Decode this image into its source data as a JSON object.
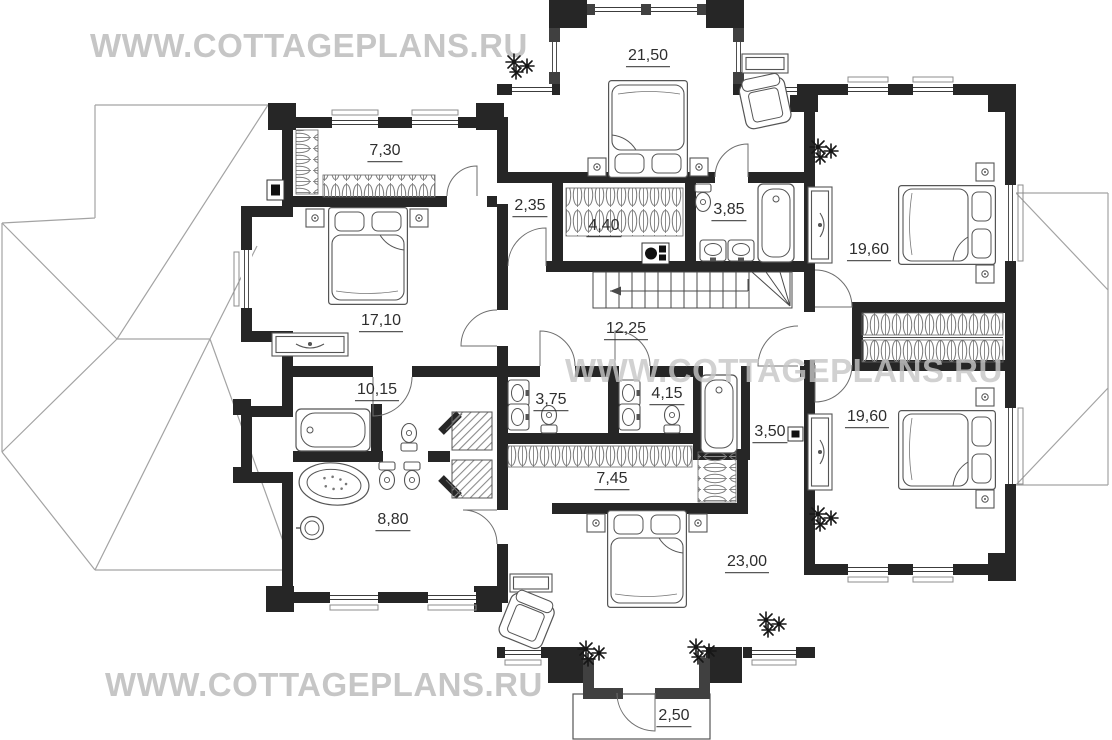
{
  "watermarks": {
    "top": "WWW.COTTAGEPLANS.RU",
    "middle": "WWW.COTTAGEPLANS.RU",
    "bottom": "WWW.COTTAGEPLANS.RU"
  },
  "plan": {
    "figure_type": "floor-plan",
    "rooms": [
      {
        "name": "bedroom-top-center",
        "area": "21,50"
      },
      {
        "name": "closet-top-left",
        "area": "7,30"
      },
      {
        "name": "hall-top",
        "area": "2,35"
      },
      {
        "name": "wardrobe-top",
        "area": "4,40"
      },
      {
        "name": "bathroom-top",
        "area": "3,85"
      },
      {
        "name": "bedroom-right-top",
        "area": "19,60"
      },
      {
        "name": "bedroom-left",
        "area": "17,10"
      },
      {
        "name": "corridor",
        "area": "12,25"
      },
      {
        "name": "bathroom-left",
        "area": "10,15"
      },
      {
        "name": "wc-left",
        "area": "3,75"
      },
      {
        "name": "wc-center",
        "area": "4,15"
      },
      {
        "name": "hall-right",
        "area": "3,50"
      },
      {
        "name": "bedroom-right-bottom",
        "area": "19,60"
      },
      {
        "name": "wardrobe-bottom",
        "area": "7,45"
      },
      {
        "name": "bathroom-bottom-left",
        "area": "8,80"
      },
      {
        "name": "bedroom-bottom-center",
        "area": "23,00"
      },
      {
        "name": "balcony",
        "area": "2,50"
      }
    ],
    "colors": {
      "wall": "#262626",
      "bay_wall": "#404040",
      "watermark": "#c6c6c6",
      "roof_line": "#a3a3a3",
      "label_text": "#2e2e2e"
    }
  }
}
